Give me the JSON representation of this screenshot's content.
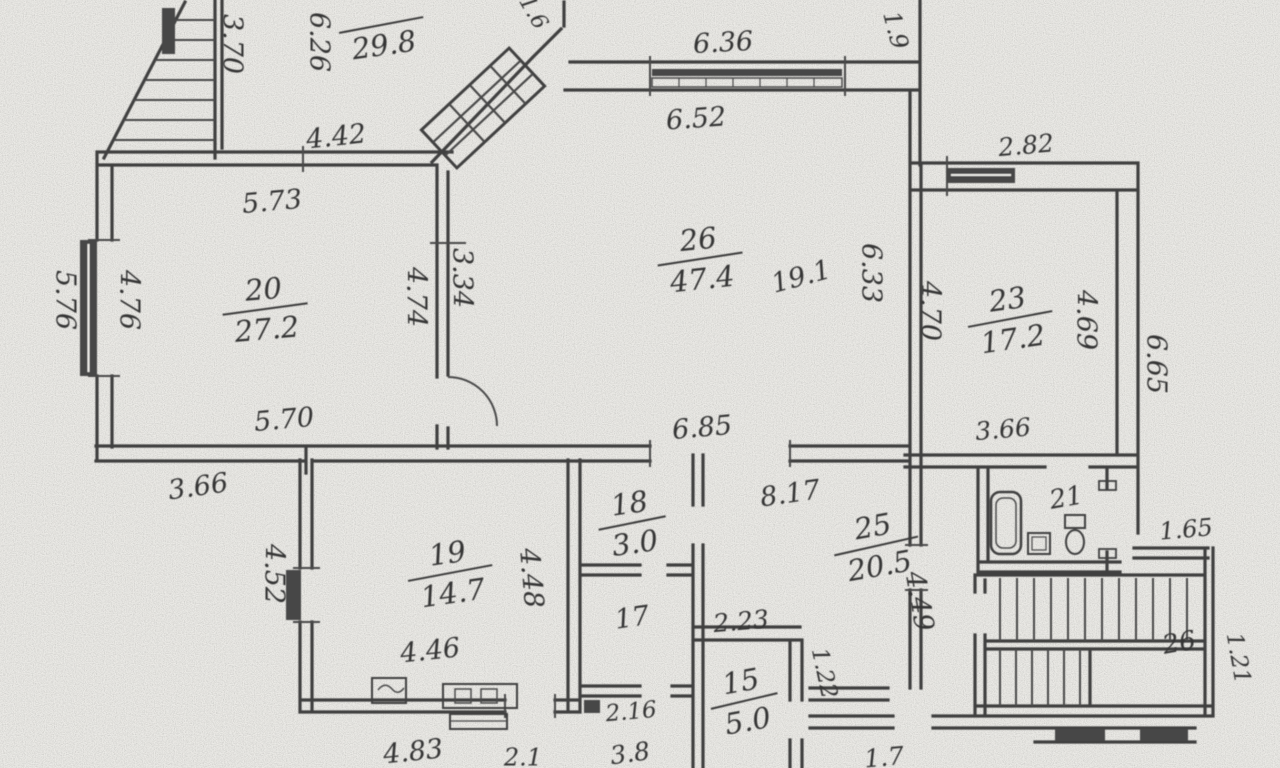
{
  "document": {
    "kind": "scanned floor plan",
    "paper_color": "#ecebe7",
    "ink_color": "#3f3f3f",
    "pencil_color": "#8a8a8a"
  },
  "plan": {
    "room_labels": [
      {
        "number": "",
        "area": "29.8",
        "x": 381,
        "y": 24,
        "rot": -8
      },
      {
        "number": "20",
        "area": "27.2",
        "x": 265,
        "y": 308,
        "rot": -5
      },
      {
        "number": "26",
        "area": "47.4",
        "x": 700,
        "y": 258,
        "rot": -6
      },
      {
        "number": "23",
        "area": "17.2",
        "x": 1010,
        "y": 318,
        "rot": -8
      },
      {
        "number": "19",
        "area": "14.7",
        "x": 450,
        "y": 572,
        "rot": -8
      },
      {
        "number": "18",
        "area": "3.0",
        "x": 632,
        "y": 522,
        "rot": -8
      },
      {
        "number": "25",
        "area": "20.5",
        "x": 876,
        "y": 545,
        "rot": -10
      },
      {
        "number": "15",
        "area": "5.0",
        "x": 744,
        "y": 700,
        "rot": -10
      }
    ],
    "room_numbers": [
      {
        "text": "21",
        "x": 1066,
        "y": 497,
        "rot": -10,
        "size": 26
      },
      {
        "text": "26",
        "x": 1179,
        "y": 642,
        "rot": -10,
        "size": 26
      },
      {
        "text": "17",
        "x": 632,
        "y": 617,
        "rot": -8,
        "size": 27
      }
    ],
    "dimensions": [
      {
        "text": "3.70",
        "x": 233,
        "y": 44,
        "rot": 90
      },
      {
        "text": "6.26",
        "x": 320,
        "y": 42,
        "rot": 90
      },
      {
        "text": "4.42",
        "x": 336,
        "y": 136,
        "rot": -6
      },
      {
        "text": "1.6",
        "x": 534,
        "y": 12,
        "rot": 60,
        "size": 22
      },
      {
        "text": "6.36",
        "x": 723,
        "y": 42,
        "rot": -3
      },
      {
        "text": "1.9",
        "x": 896,
        "y": 30,
        "rot": 75,
        "size": 24
      },
      {
        "text": "6.52",
        "x": 696,
        "y": 118,
        "rot": -4
      },
      {
        "text": "2.82",
        "x": 1026,
        "y": 145,
        "rot": -5,
        "size": 25
      },
      {
        "text": "5.73",
        "x": 272,
        "y": 201,
        "rot": -5
      },
      {
        "text": "4.76",
        "x": 130,
        "y": 300,
        "rot": 90
      },
      {
        "text": "5.76",
        "x": 66,
        "y": 300,
        "rot": 90
      },
      {
        "text": "4.74",
        "x": 417,
        "y": 297,
        "rot": 90
      },
      {
        "text": "3.34",
        "x": 463,
        "y": 278,
        "rot": 90
      },
      {
        "text": "6.33",
        "x": 872,
        "y": 273,
        "rot": 90
      },
      {
        "text": "19.1",
        "x": 801,
        "y": 276,
        "rot": -15,
        "light": true
      },
      {
        "text": "4.70",
        "x": 931,
        "y": 311,
        "rot": 90
      },
      {
        "text": "4.69",
        "x": 1087,
        "y": 320,
        "rot": 90
      },
      {
        "text": "6.65",
        "x": 1157,
        "y": 364,
        "rot": 90
      },
      {
        "text": "3.66",
        "x": 1003,
        "y": 429,
        "rot": -5,
        "size": 25
      },
      {
        "text": "6.85",
        "x": 702,
        "y": 427,
        "rot": -5
      },
      {
        "text": "5.70",
        "x": 284,
        "y": 419,
        "rot": -5
      },
      {
        "text": "3.66",
        "x": 198,
        "y": 486,
        "rot": -8
      },
      {
        "text": "8.17",
        "x": 790,
        "y": 493,
        "rot": -8
      },
      {
        "text": "4.52",
        "x": 275,
        "y": 574,
        "rot": 90
      },
      {
        "text": "4.48",
        "x": 532,
        "y": 578,
        "rot": 85
      },
      {
        "text": "4.49",
        "x": 920,
        "y": 601,
        "rot": 80
      },
      {
        "text": "2.23",
        "x": 741,
        "y": 621,
        "rot": -5,
        "size": 25
      },
      {
        "text": "4.46",
        "x": 430,
        "y": 650,
        "rot": -6
      },
      {
        "text": "1.22",
        "x": 825,
        "y": 673,
        "rot": 78,
        "size": 23
      },
      {
        "text": "1.65",
        "x": 1186,
        "y": 529,
        "rot": -5,
        "size": 24
      },
      {
        "text": "1.21",
        "x": 1239,
        "y": 658,
        "rot": 80,
        "size": 23
      },
      {
        "text": "2.16",
        "x": 631,
        "y": 711,
        "rot": -5,
        "size": 23
      },
      {
        "text": "4.83",
        "x": 413,
        "y": 751,
        "rot": -6
      },
      {
        "text": "2.1",
        "x": 523,
        "y": 757,
        "rot": 0,
        "size": 24
      },
      {
        "text": "3.8",
        "x": 630,
        "y": 753,
        "rot": -8,
        "size": 25
      },
      {
        "text": "1.7",
        "x": 884,
        "y": 757,
        "rot": -5,
        "size": 25
      }
    ]
  }
}
